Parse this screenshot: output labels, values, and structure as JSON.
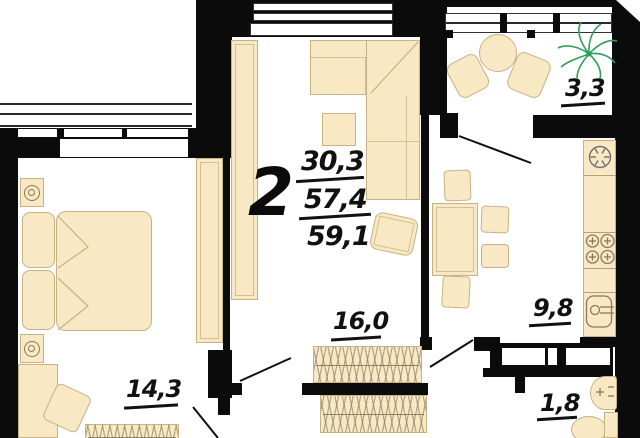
{
  "plan_title": "2-room apartment floor plan",
  "summary": {
    "rooms_count": "2",
    "living_area": "30,3",
    "apartment_area": "57,4",
    "total_area": "59,1"
  },
  "room_labels": {
    "living_room": "16,0",
    "bedroom": "14,3",
    "kitchen": "9,8",
    "balcony": "3,3",
    "bathroom": "1,8"
  },
  "icons": {
    "plant": "plant-icon",
    "vent": "vent-fan-icon",
    "stove": "stove-burners-icon",
    "sink": "kitchen-sink-icon",
    "washbasin": "washbasin-icon",
    "toilet": "toilet-icon",
    "lamp": "bedside-lamp-icon"
  },
  "colors": {
    "wall": "#0b0b0b",
    "furniture_fill": "#f8e8c4",
    "furniture_border": "#c6b283",
    "plant_green": "#2f9e57",
    "background": "#ffffff"
  }
}
